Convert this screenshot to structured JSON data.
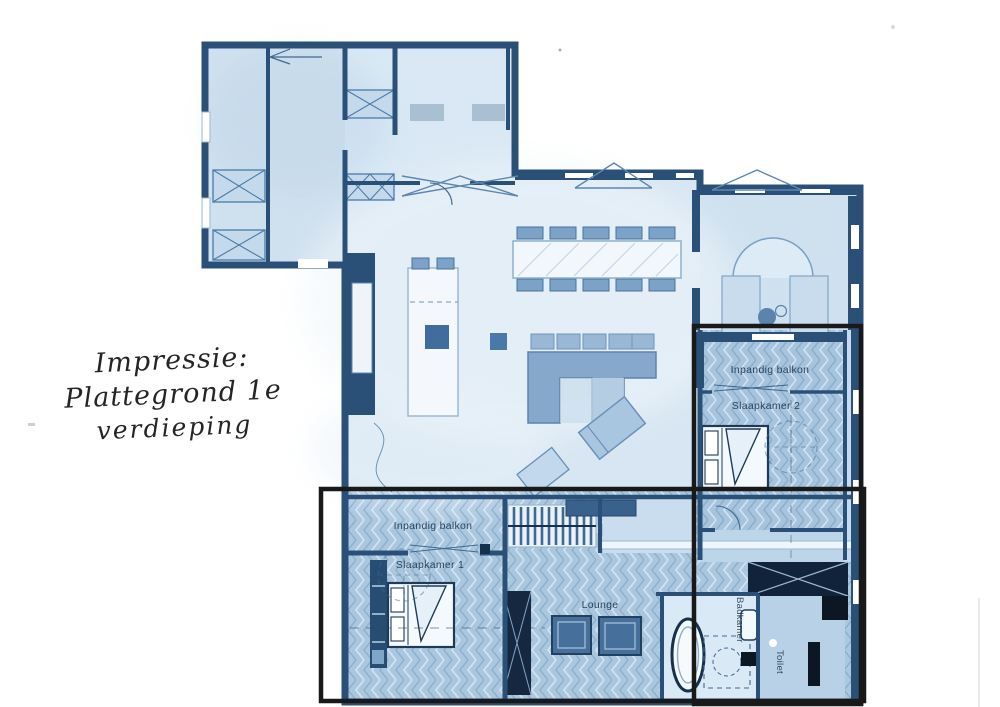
{
  "title": {
    "line1": "Impressie: Plattegrond 1e",
    "line2": "verdieping"
  },
  "plan": {
    "labels": {
      "right_unit_balcony": "Inpandig balkon",
      "bedroom2": "Slaapkamer 2",
      "bottom_unit_balcony": "Inpandig balkon",
      "bedroom1": "Slaapkamer 1",
      "lounge": "Lounge",
      "bathroom": "Badkamer",
      "toilet": "Toilet"
    },
    "colors": {
      "wall": "#2b5078",
      "floor_light": "#d7e6f2",
      "floor_unit": "#aac7e0",
      "furniture_blue": "#7fa5c9",
      "dark_fixture": "#0d1724",
      "highlight_outline": "#191919"
    }
  }
}
